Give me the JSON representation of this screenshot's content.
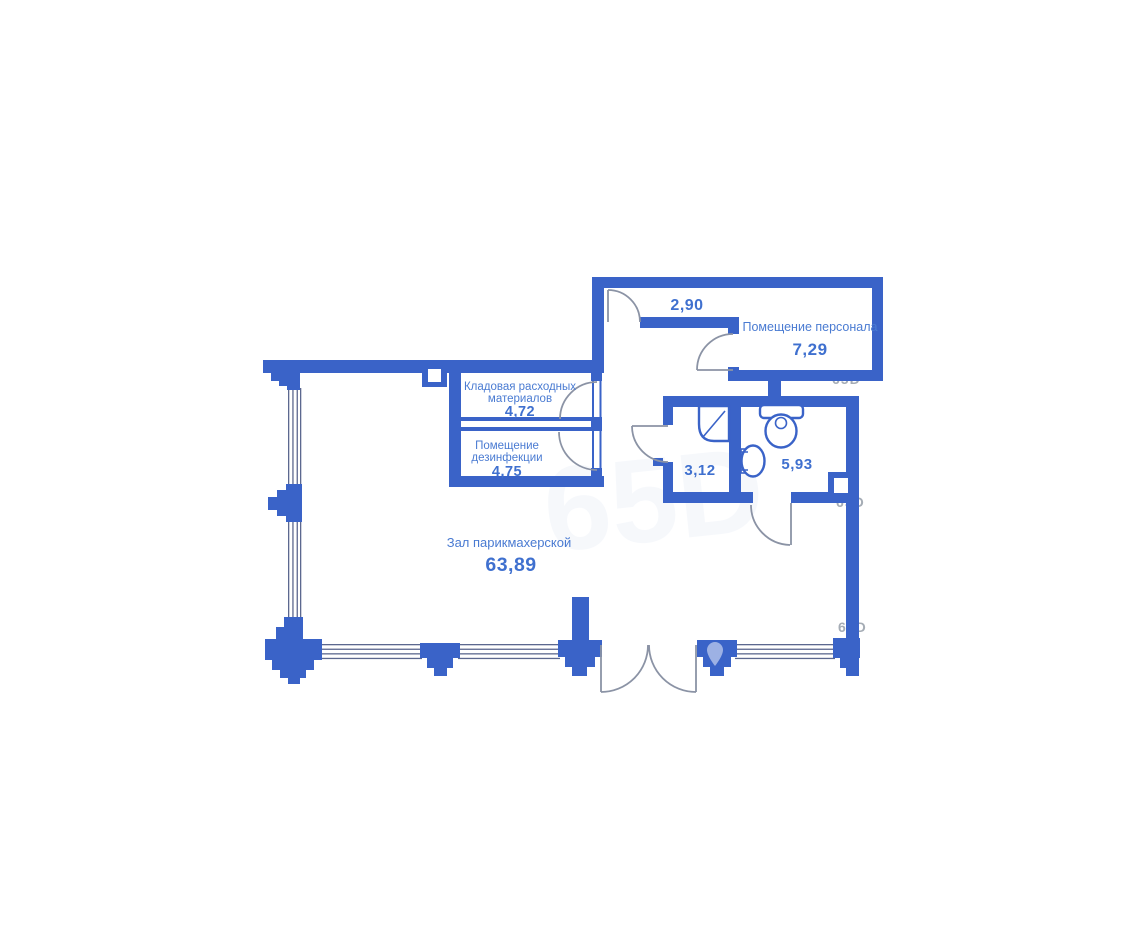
{
  "document": {
    "type": "floor-plan-scan",
    "background": "#ffffff"
  },
  "colors": {
    "wall": "#3a63c8",
    "room_label": "#4a7bd2",
    "room_value": "#3f70cf",
    "door_swing_line": "#8b93a5",
    "window_line": "#5c688f",
    "watermark": "#8f98a3"
  },
  "rooms": {
    "vestibule": {
      "area": "2,90"
    },
    "staff": {
      "name": "Помещение персонала",
      "area": "7,29"
    },
    "storage": {
      "name_line1": "Кладовая расходных",
      "name_line2": "материалов",
      "area": "4,72"
    },
    "disinfection": {
      "name_line1": "Помещение",
      "name_line2": "дезинфекции",
      "area": "4,75"
    },
    "shower_room": {
      "area": "3,12"
    },
    "wc": {
      "area": "5,93"
    },
    "salon": {
      "name": "Зал парикмахерской",
      "area": "63,89"
    }
  },
  "icons": {
    "shower": "shower-cabin-icon",
    "toilet": "toilet-icon",
    "sink": "sink-icon",
    "pin": "map-pin-watermark-icon"
  },
  "watermark": {
    "fragment": "65D"
  }
}
